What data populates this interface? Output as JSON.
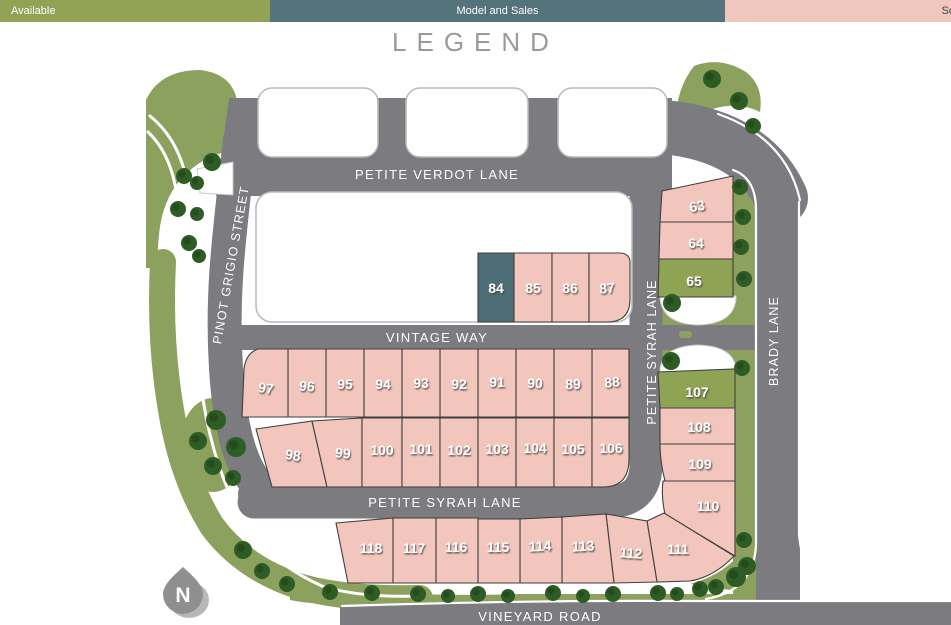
{
  "legend": {
    "title": "LEGEND",
    "items": [
      {
        "label": "Available",
        "color": "#92a355",
        "text_color": "#ffffff"
      },
      {
        "label": "Model and Sales",
        "color": "#54737a",
        "text_color": "#ffffff"
      },
      {
        "label": "Sold",
        "color": "#f0c7be",
        "text_color": "#424242"
      }
    ]
  },
  "map": {
    "streets": {
      "petite_verdot": "PETITE VERDOT LANE",
      "pinot_grigio": "PINOT GRIGIO STREET",
      "vintage_way": "VINTAGE WAY",
      "petite_syrah_vertical": "PETITE SYRAH LANE",
      "petite_syrah_horizontal": "PETITE SYRAH LANE",
      "brady": "BRADY LANE",
      "vineyard": "VINEYARD ROAD"
    },
    "north_label": "N",
    "lots": [
      {
        "number": "63",
        "status": "sold"
      },
      {
        "number": "64",
        "status": "sold"
      },
      {
        "number": "65",
        "status": "available"
      },
      {
        "number": "84",
        "status": "model-and-sales"
      },
      {
        "number": "85",
        "status": "sold"
      },
      {
        "number": "86",
        "status": "sold"
      },
      {
        "number": "87",
        "status": "sold"
      },
      {
        "number": "88",
        "status": "sold"
      },
      {
        "number": "89",
        "status": "sold"
      },
      {
        "number": "90",
        "status": "sold"
      },
      {
        "number": "91",
        "status": "sold"
      },
      {
        "number": "92",
        "status": "sold"
      },
      {
        "number": "93",
        "status": "sold"
      },
      {
        "number": "94",
        "status": "sold"
      },
      {
        "number": "95",
        "status": "sold"
      },
      {
        "number": "96",
        "status": "sold"
      },
      {
        "number": "97",
        "status": "sold"
      },
      {
        "number": "98",
        "status": "sold"
      },
      {
        "number": "99",
        "status": "sold"
      },
      {
        "number": "100",
        "status": "sold"
      },
      {
        "number": "101",
        "status": "sold"
      },
      {
        "number": "102",
        "status": "sold"
      },
      {
        "number": "103",
        "status": "sold"
      },
      {
        "number": "104",
        "status": "sold"
      },
      {
        "number": "105",
        "status": "sold"
      },
      {
        "number": "106",
        "status": "sold"
      },
      {
        "number": "107",
        "status": "available"
      },
      {
        "number": "108",
        "status": "sold"
      },
      {
        "number": "109",
        "status": "sold"
      },
      {
        "number": "110",
        "status": "sold"
      },
      {
        "number": "111",
        "status": "sold"
      },
      {
        "number": "112",
        "status": "sold"
      },
      {
        "number": "113",
        "status": "sold"
      },
      {
        "number": "114",
        "status": "sold"
      },
      {
        "number": "115",
        "status": "sold"
      },
      {
        "number": "116",
        "status": "sold"
      },
      {
        "number": "117",
        "status": "sold"
      },
      {
        "number": "118",
        "status": "sold"
      }
    ]
  },
  "colors": {
    "available": "#92a355",
    "model_and_sales": "#54737a",
    "sold": "#f2c6bc",
    "road": "#7b7b80",
    "landscape": "#8da15e",
    "tree": "#2e5c25",
    "legend_title": "#9a9a9a"
  }
}
